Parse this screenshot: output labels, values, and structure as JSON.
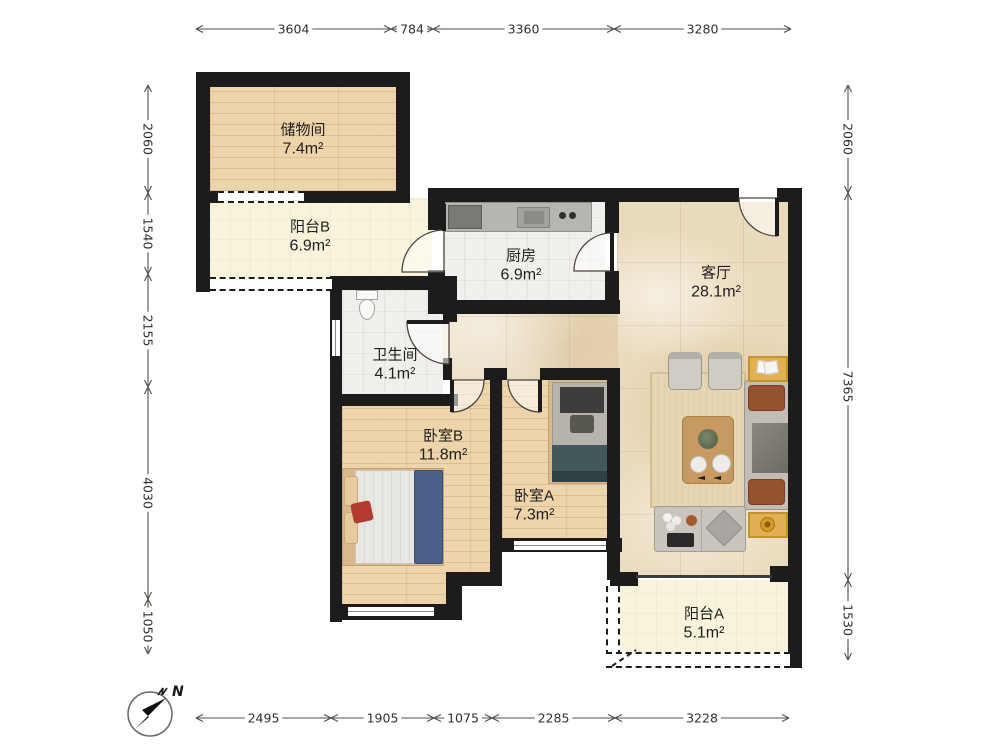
{
  "plan": {
    "rooms": {
      "storage": {
        "name": "储物间",
        "area": "7.4m²"
      },
      "balcony_b": {
        "name": "阳台B",
        "area": "6.9m²"
      },
      "kitchen": {
        "name": "厨房",
        "area": "6.9m²"
      },
      "living": {
        "name": "客厅",
        "area": "28.1m²"
      },
      "bathroom": {
        "name": "卫生间",
        "area": "4.1m²"
      },
      "bedroom_b": {
        "name": "卧室B",
        "area": "11.8m²"
      },
      "bedroom_a": {
        "name": "卧室A",
        "area": "7.3m²"
      },
      "balcony_a": {
        "name": "阳台A",
        "area": "5.1m²"
      }
    },
    "dimensions": {
      "top": [
        "3604",
        "784",
        "3360",
        "3280"
      ],
      "bottom": [
        "2495",
        "1905",
        "1075",
        "2285",
        "3228"
      ],
      "left": [
        "2060",
        "1540",
        "2155",
        "4030",
        "1050"
      ],
      "right": [
        "2060",
        "7365",
        "1530"
      ]
    },
    "compass": {
      "label": "N"
    },
    "colors": {
      "wall": "#1c1c1c",
      "wood_floor": "#eed4aa",
      "balcony_floor": "#f8f4db",
      "tile_floor": "#f1efec",
      "marble_floor": "#ebdbbd",
      "accent_table": "#e2af52",
      "bed_blue": "#4a608a",
      "bed_teal": "#41595b",
      "dimension_text": "#332f2b"
    }
  }
}
